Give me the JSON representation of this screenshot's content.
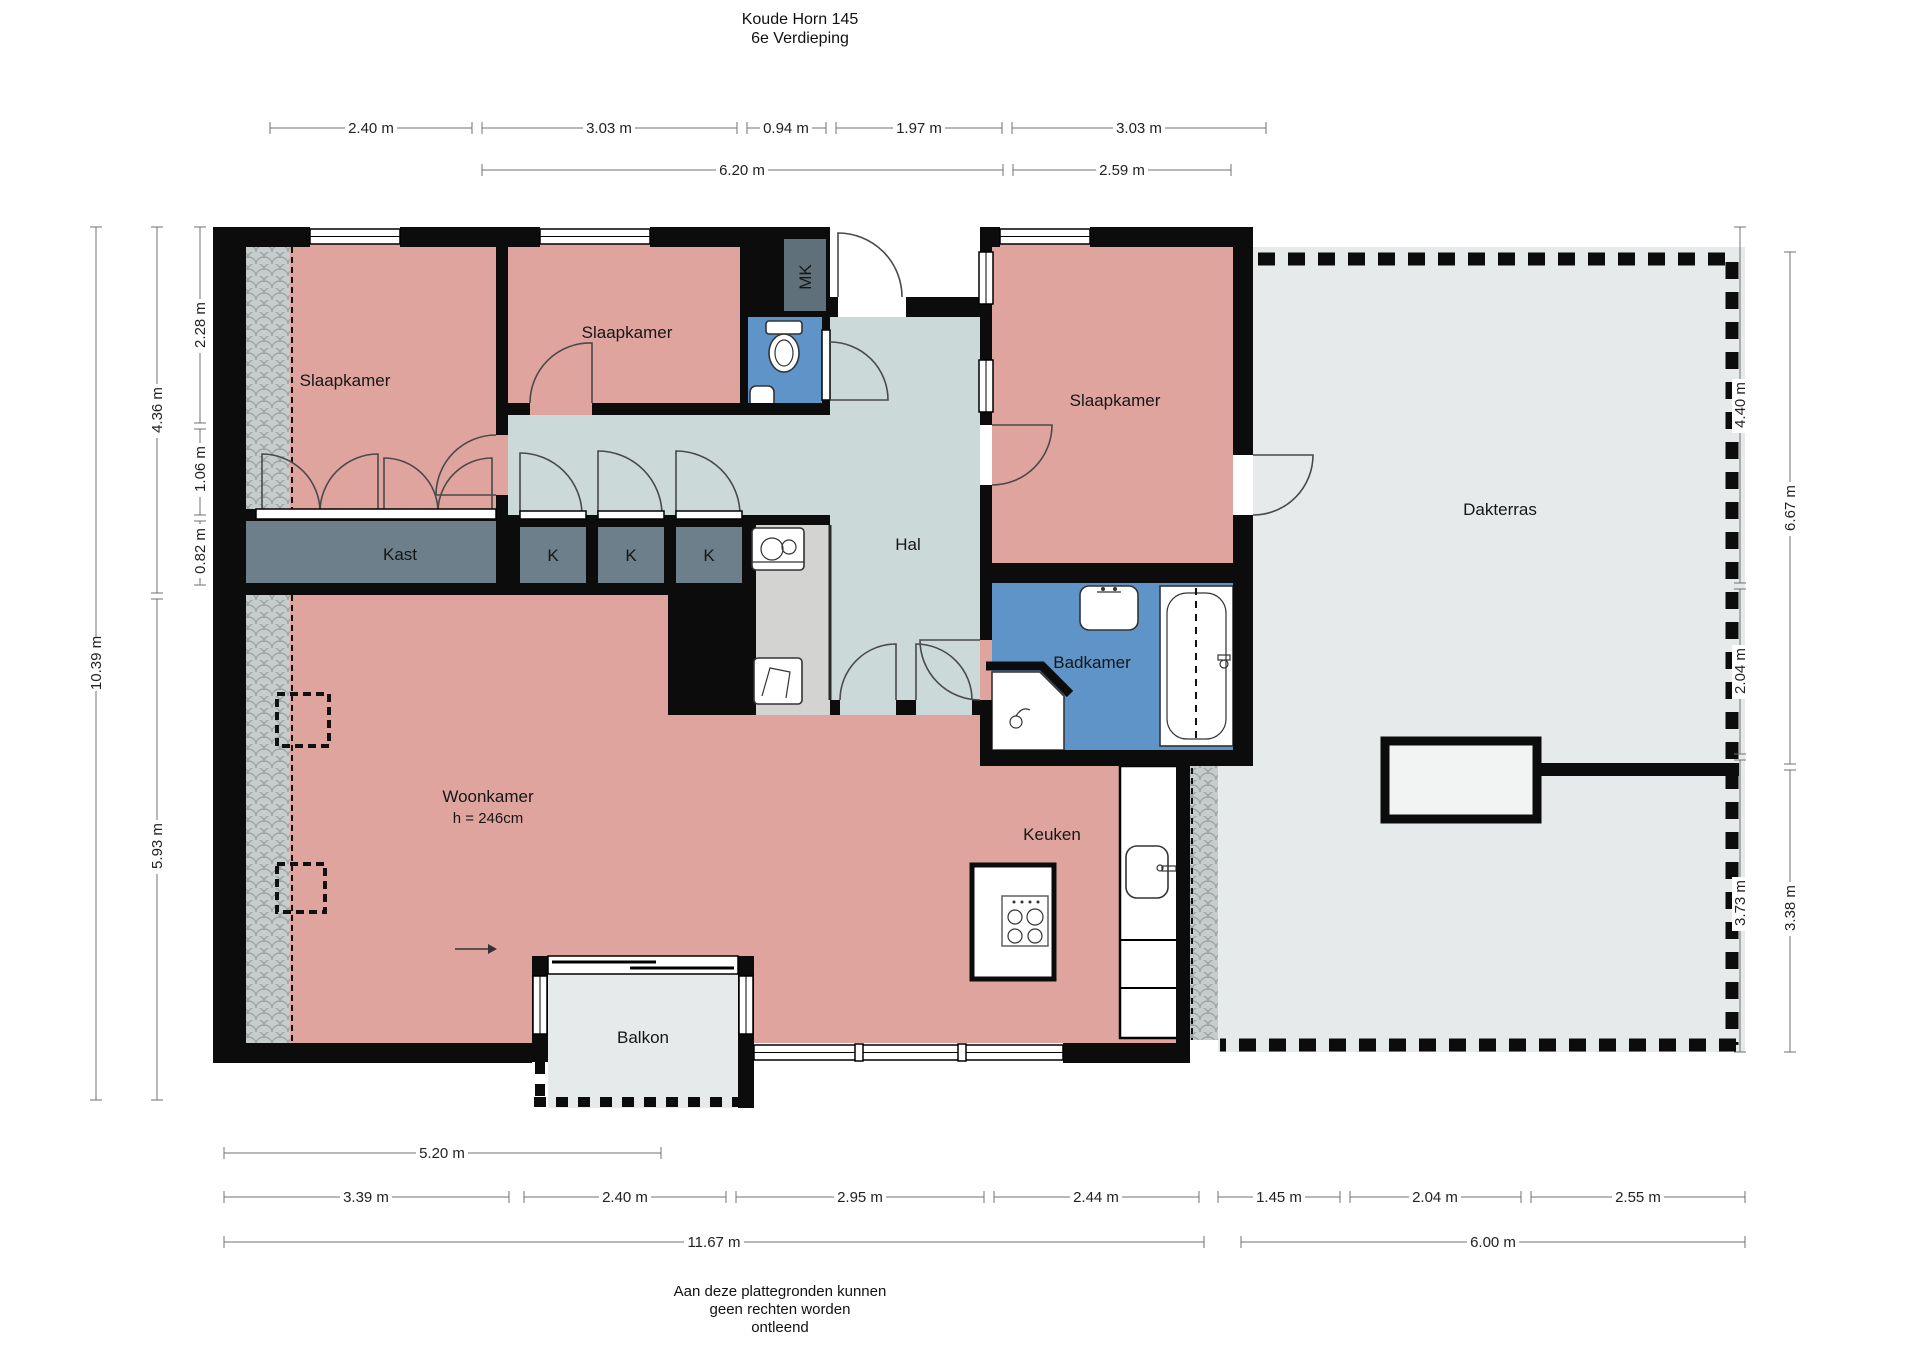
{
  "title": {
    "address": "Koude Horn 145",
    "floor": "6e Verdieping"
  },
  "rooms": {
    "bedroom_tl": "Slaapkamer",
    "bedroom_tm": "Slaapkamer",
    "bedroom_tr": "Slaapkamer",
    "meter_cupboard": "MK",
    "hall": "Hal",
    "closet": "Kast",
    "k1": "K",
    "k2": "K",
    "k3": "K",
    "bathroom": "Badkamer",
    "living_room": "Woonkamer",
    "living_room_height": "h = 246cm",
    "kitchen": "Keuken",
    "balcony": "Balkon",
    "roof_terrace": "Dakterras"
  },
  "dimensions": {
    "top_row1": [
      "2.40 m",
      "3.03 m",
      "0.94 m",
      "1.97 m",
      "3.03 m"
    ],
    "top_row2": [
      "6.20 m",
      "2.59 m"
    ],
    "left_total": "10.39 m",
    "left_mid": [
      "4.36 m",
      "5.93 m"
    ],
    "left_inner": [
      "2.28 m",
      "1.06 m",
      "0.82 m"
    ],
    "right_inner": [
      "4.40 m",
      "2.04 m",
      "3.73 m"
    ],
    "right_outer": [
      "6.67 m",
      "3.38 m"
    ],
    "bottom_row1": "5.20 m",
    "bottom_row2_left": [
      "3.39 m",
      "2.40 m",
      "2.95 m",
      "2.44 m"
    ],
    "bottom_row2_right": [
      "1.45 m",
      "2.04 m",
      "2.55 m"
    ],
    "bottom_total_left": "11.67 m",
    "bottom_total_right": "6.00 m"
  },
  "footer": [
    "Aan deze plattegronden kunnen",
    "geen rechten worden",
    "ontleend"
  ],
  "colors": {
    "room_pink": "#dfa49d",
    "hall_gray_blue": "#ccd9d9",
    "wet_room_blue": "#5e94c8",
    "closet_slate": "#6c7f8a",
    "terrace_gray": "#e7eaea",
    "wall_black": "#0c0c0c"
  }
}
